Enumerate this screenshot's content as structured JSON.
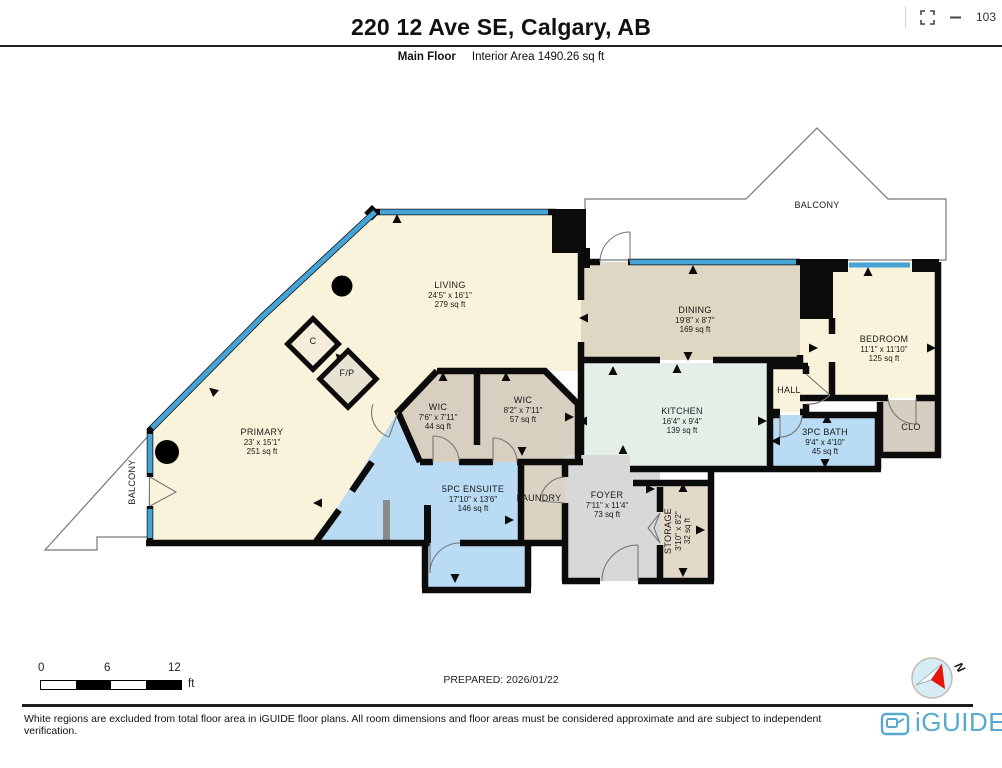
{
  "viewer": {
    "zoom_value": "103",
    "fullscreen_icon": "fullscreen-icon",
    "zoom_out_icon": "minus-icon"
  },
  "header": {
    "title": "220 12 Ave SE, Calgary, AB",
    "floor_label": "Main Floor",
    "interior_area": "Interior Area 1490.26 sq ft"
  },
  "plan": {
    "rooms": [
      {
        "id": "living",
        "name": "LIVING",
        "dims": "24'5\" x 16'1\"",
        "area": "279 sq ft",
        "x": 450,
        "y": 288
      },
      {
        "id": "dining",
        "name": "DINING",
        "dims": "19'8\" x 8'7\"",
        "area": "169 sq ft",
        "x": 695,
        "y": 313
      },
      {
        "id": "bedroom",
        "name": "BEDROOM",
        "dims": "11'1\" x 11'10\"",
        "area": "125 sq ft",
        "x": 884,
        "y": 342
      },
      {
        "id": "primary",
        "name": "PRIMARY",
        "dims": "23' x 15'1\"",
        "area": "251 sq ft",
        "x": 262,
        "y": 435
      },
      {
        "id": "wic1",
        "name": "WIC",
        "dims": "7'6\" x 7'11\"",
        "area": "44 sq ft",
        "x": 438,
        "y": 410
      },
      {
        "id": "wic2",
        "name": "WIC",
        "dims": "8'2\" x 7'11\"",
        "area": "57 sq ft",
        "x": 523,
        "y": 403
      },
      {
        "id": "kitchen",
        "name": "KITCHEN",
        "dims": "16'4\" x 9'4\"",
        "area": "139 sq ft",
        "x": 682,
        "y": 414
      },
      {
        "id": "ensuite",
        "name": "5PC ENSUITE",
        "dims": "17'10\" x 13'6\"",
        "area": "146 sq ft",
        "x": 473,
        "y": 492
      },
      {
        "id": "bath",
        "name": "3PC BATH",
        "dims": "9'4\" x 4'10\"",
        "area": "45 sq ft",
        "x": 825,
        "y": 435
      },
      {
        "id": "foyer",
        "name": "FOYER",
        "dims": "7'11\" x 11'4\"",
        "area": "73 sq ft",
        "x": 607,
        "y": 498
      },
      {
        "id": "storage",
        "name": "STORAGE",
        "dims": "3'10\" x 8'2\"",
        "area": "32 sq ft",
        "x": 671,
        "y": 531,
        "rot": -90
      },
      {
        "id": "laundry",
        "name": "LAUNDRY",
        "x": 539,
        "y": 501,
        "fs": 8
      },
      {
        "id": "hall",
        "name": "HALL",
        "x": 789,
        "y": 393
      },
      {
        "id": "clo",
        "name": "CLO",
        "x": 911,
        "y": 430
      },
      {
        "id": "closet-c",
        "name": "C",
        "x": 313,
        "y": 344,
        "fs": 8
      },
      {
        "id": "fireplace",
        "name": "F/P",
        "x": 347,
        "y": 376,
        "fs": 8
      },
      {
        "id": "balcony-top",
        "name": "BALCONY",
        "x": 817,
        "y": 208,
        "fs": 8.5
      },
      {
        "id": "balcony-left",
        "name": "BALCONY",
        "x": 135,
        "y": 482,
        "rot": -90,
        "fs": 8.5
      }
    ]
  },
  "scale_bar": {
    "t0": "0",
    "t1": "6",
    "t2": "12",
    "unit": "ft"
  },
  "footer": {
    "prepared": "PREPARED: 2026/01/22",
    "compass_n": "N",
    "disclaimer": "White regions are excluded from total floor area in iGUIDE floor plans. All room dimensions and floor areas must be considered approximate and are subject to independent verification.",
    "brand": "iGUIDE"
  },
  "colors": {
    "wall": "#0B0B0B",
    "window": "#45A3D6",
    "room_cream": "#FAF3DB",
    "room_tan_dining": "#DFD6C3",
    "room_tan_wic": "#D9CFC0",
    "room_tan_storage": "#E3D9C8",
    "room_mint": "#E4EFE8",
    "room_blue": "#B9DBF4",
    "room_gray": "#D8D8D8",
    "room_clo": "#D7CEC2",
    "brand_blue": "#57A9CD"
  }
}
